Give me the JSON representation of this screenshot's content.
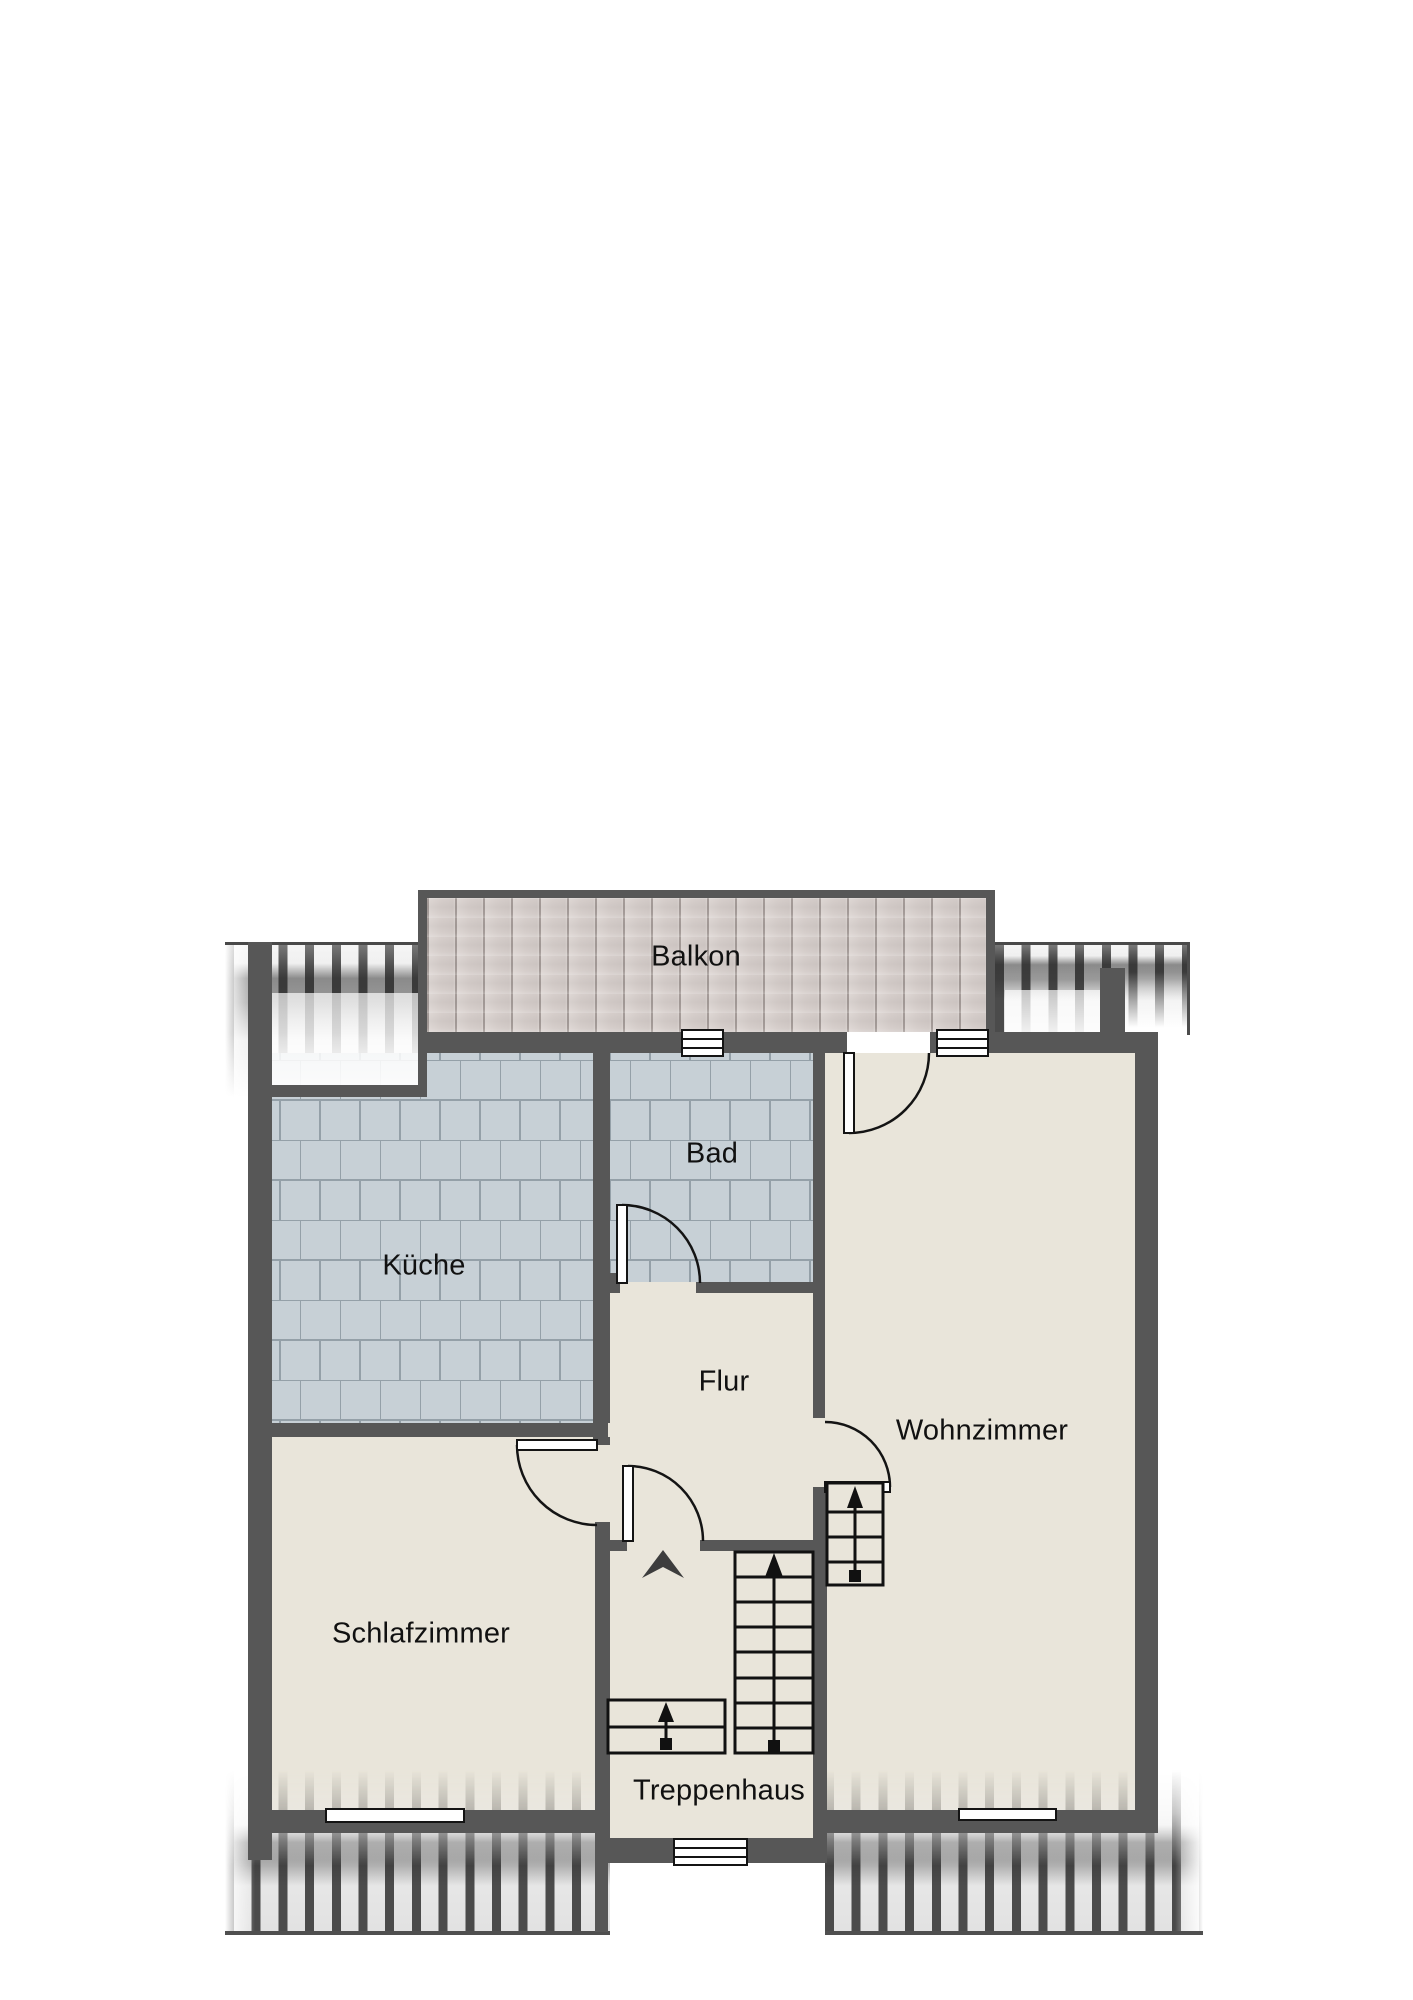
{
  "plan": {
    "type": "apartment-floor-plan",
    "language": "de",
    "rooms": [
      {
        "id": "balkon",
        "label": "Balkon",
        "floor": "wood-deck"
      },
      {
        "id": "kueche",
        "label": "Küche",
        "floor": "tile"
      },
      {
        "id": "bad",
        "label": "Bad",
        "floor": "tile"
      },
      {
        "id": "flur",
        "label": "Flur",
        "floor": "screed"
      },
      {
        "id": "wohnzimmer",
        "label": "Wohnzimmer",
        "floor": "screed"
      },
      {
        "id": "schlafzimmer",
        "label": "Schlafzimmer",
        "floor": "screed"
      },
      {
        "id": "treppenhaus",
        "label": "Treppenhaus",
        "floor": "screed"
      }
    ],
    "symbols": {
      "doors": [
        "balkon-wohnzimmer",
        "flur-bad",
        "flur-wohnzimmer",
        "flur-schlafzimmer",
        "flur-treppenhaus"
      ],
      "windows": [
        "bad-balkon",
        "wohnzimmer-balkon",
        "schlafzimmer-sued",
        "wohnzimmer-sued",
        "treppenhaus-sued"
      ],
      "stairs": [
        "treppenhaus-hauptlauf",
        "oberer-lauf",
        "antritt"
      ],
      "arrows": [
        "treppen-richtungspfeile-aufwaerts",
        "eingangspfeil"
      ]
    },
    "colors": {
      "wall": "#575757",
      "floor_beige": "#e9e5da",
      "tile": "#c7d0d6",
      "tile_grout": "#94a0a8",
      "plank": "#d8d1ce",
      "plank_line": "#a59c99",
      "roof_stripe": "#4b4b4b",
      "line_black": "#141414",
      "arrow_dark": "#3d3d3d",
      "window_white": "#ffffff"
    }
  }
}
